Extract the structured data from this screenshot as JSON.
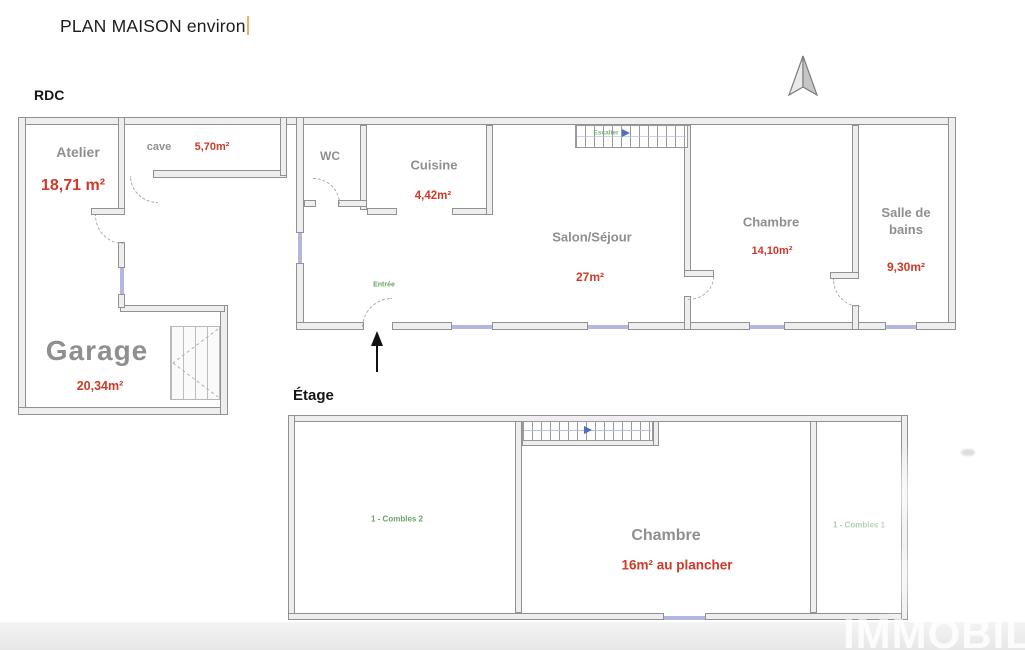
{
  "title": {
    "text": "PLAN MAISON environ"
  },
  "floors": {
    "rdc": {
      "label": "RDC"
    },
    "etage": {
      "label": "Étage"
    }
  },
  "rooms": {
    "atelier": {
      "name": "Atelier",
      "area": "18,71 m²"
    },
    "cave": {
      "name": "cave",
      "area": "5,70m²"
    },
    "wc": {
      "name": "WC"
    },
    "cuisine": {
      "name": "Cuisine",
      "area": "4,42m²"
    },
    "salon": {
      "name": "Salon/Séjour",
      "area": "27m²"
    },
    "chambre_rdc": {
      "name": "Chambre",
      "area": "14,10m²"
    },
    "salle_de_bains": {
      "name": "Salle de bains",
      "area": "9,30m²"
    },
    "garage": {
      "name": "Garage",
      "area": "20,34m²"
    },
    "chambre_etage": {
      "name": "Chambre",
      "area": "16m² au plancher"
    },
    "combles2": {
      "name": "1 - Combles 2"
    },
    "combles1": {
      "name": "1 - Combles 1"
    }
  },
  "annotations": {
    "entree": "Entrée",
    "escalier": "Escalier"
  },
  "watermark": {
    "text": "IMMOBIL"
  },
  "colors": {
    "area_red": "#cf3928",
    "room_label_gray": "#8f8f8f",
    "annotation_green": "#69a369",
    "window_blue": "#b3b7e0",
    "wall_gray": "#919191",
    "stair_arrow_blue": "#4f6fc4",
    "cursor_orange": "#efb06e",
    "watermark_white": "#ffffff"
  }
}
